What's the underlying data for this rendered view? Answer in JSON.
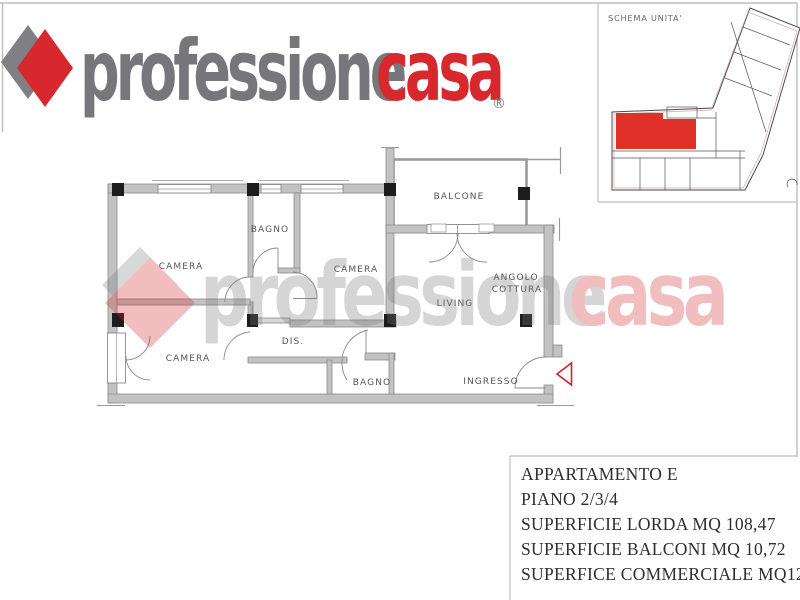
{
  "logo": {
    "word_gray": "professione",
    "word_red": "casa",
    "registered_mark": "®",
    "colors": {
      "gray": "#77777b",
      "red": "#d7282e",
      "diamond_gray": "#808084",
      "diamond_red": "#d7282e"
    }
  },
  "schema_unit": {
    "title": "SCHEMA UNITA'",
    "highlight_color": "#e1302a"
  },
  "floorplan": {
    "rooms": {
      "camera_top_left": "CAMERA",
      "bagno_top": "BAGNO",
      "camera_top_center": "CAMERA",
      "balcone": "BALCONE",
      "angolo_cottura_line1": "ANGOLO",
      "angolo_cottura_line2": "COTTURA",
      "living": "LIVING",
      "camera_bottom_left": "CAMERA",
      "disimpegno": "DIS.",
      "bagno_bottom": "BAGNO",
      "ingresso": "INGRESSO"
    },
    "colors": {
      "wall": "#c2c2c2",
      "wall_edge": "#8a8a8a",
      "pillar": "#1d1d1d",
      "entrance_arrow": "#cc2229"
    }
  },
  "watermark": {
    "word_gray": "professione",
    "word_red": "casa"
  },
  "info_panel": {
    "lines": [
      "APPARTAMENTO E",
      "PIANO 2/3/4",
      "SUPERFICIE LORDA MQ 108,47",
      "SUPERFICIE BALCONI MQ 10,72",
      "SUPERFICE COMMERCIALE MQ125,21"
    ]
  }
}
